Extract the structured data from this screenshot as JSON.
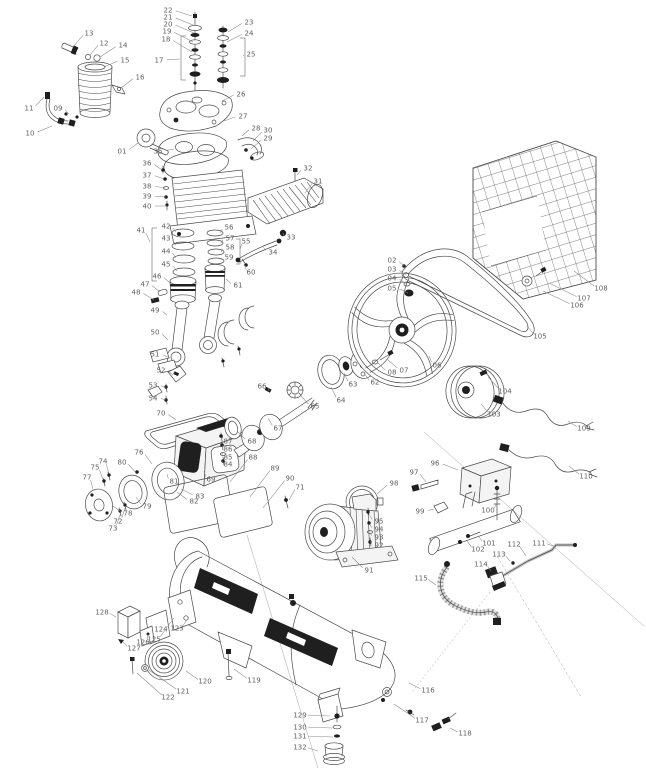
{
  "diagram": {
    "type": "exploded-parts-diagram",
    "canvas": {
      "width": 646,
      "height": 768
    },
    "colors": {
      "background": "#ffffff",
      "line": "#4a4a4a",
      "label": "#5f5f5f",
      "dark_fill": "#1f1f1f"
    },
    "callouts": [
      {
        "label": "22",
        "x": 168,
        "y": 10,
        "ex": 192,
        "ey": 16
      },
      {
        "label": "21",
        "x": 168,
        "y": 17,
        "ex": 193,
        "ey": 25
      },
      {
        "label": "20",
        "x": 168,
        "y": 24,
        "ex": 194,
        "ey": 33
      },
      {
        "label": "19",
        "x": 167,
        "y": 31,
        "ex": 193,
        "ey": 42
      },
      {
        "label": "18",
        "x": 166,
        "y": 39,
        "ex": 192,
        "ey": 52
      },
      {
        "label": "17",
        "x": 159,
        "y": 60,
        "ex": 180,
        "ey": 59
      },
      {
        "label": "23",
        "x": 249,
        "y": 22,
        "ex": 228,
        "ey": 32
      },
      {
        "label": "24",
        "x": 249,
        "y": 33,
        "ex": 227,
        "ey": 42
      },
      {
        "label": "25",
        "x": 251,
        "y": 54,
        "ex": 244,
        "ey": 56
      },
      {
        "label": "13",
        "x": 89,
        "y": 33,
        "ex": 73,
        "ey": 47
      },
      {
        "label": "12",
        "x": 104,
        "y": 43,
        "ex": 90,
        "ey": 55
      },
      {
        "label": "14",
        "x": 123,
        "y": 45,
        "ex": 100,
        "ey": 57
      },
      {
        "label": "15",
        "x": 125,
        "y": 60,
        "ex": 104,
        "ey": 67
      },
      {
        "label": "16",
        "x": 140,
        "y": 77,
        "ex": 121,
        "ey": 88
      },
      {
        "label": "11",
        "x": 29,
        "y": 108,
        "ex": 44,
        "ey": 97
      },
      {
        "label": "09",
        "x": 58,
        "y": 108,
        "ex": 69,
        "ey": 114
      },
      {
        "label": "10",
        "x": 30,
        "y": 133,
        "ex": 52,
        "ey": 126
      },
      {
        "label": "01",
        "x": 122,
        "y": 151,
        "ex": 138,
        "ey": 143
      },
      {
        "label": "26",
        "x": 241,
        "y": 94,
        "ex": 222,
        "ey": 101
      },
      {
        "label": "27",
        "x": 243,
        "y": 116,
        "ex": 224,
        "ey": 121
      },
      {
        "label": "28",
        "x": 256,
        "y": 128,
        "ex": 242,
        "ey": 136
      },
      {
        "label": "30",
        "x": 268,
        "y": 130,
        "ex": 253,
        "ey": 141
      },
      {
        "label": "29",
        "x": 268,
        "y": 138,
        "ex": 251,
        "ey": 149
      },
      {
        "label": "32",
        "x": 308,
        "y": 168,
        "ex": 297,
        "ey": 175
      },
      {
        "label": "31",
        "x": 318,
        "y": 181,
        "ex": 305,
        "ey": 193
      },
      {
        "label": "33",
        "x": 291,
        "y": 237,
        "ex": 283,
        "ey": 233
      },
      {
        "label": "34",
        "x": 273,
        "y": 252,
        "ex": 263,
        "ey": 247
      },
      {
        "label": "35",
        "x": 158,
        "y": 151,
        "ex": 174,
        "ey": 149
      },
      {
        "label": "36",
        "x": 147,
        "y": 163,
        "ex": 162,
        "ey": 170
      },
      {
        "label": "37",
        "x": 147,
        "y": 175,
        "ex": 164,
        "ey": 179
      },
      {
        "label": "38",
        "x": 147,
        "y": 186,
        "ex": 165,
        "ey": 188
      },
      {
        "label": "39",
        "x": 147,
        "y": 196,
        "ex": 166,
        "ey": 197
      },
      {
        "label": "40",
        "x": 147,
        "y": 206,
        "ex": 167,
        "ey": 206
      },
      {
        "label": "41",
        "x": 141,
        "y": 230,
        "ex": 150,
        "ey": 242
      },
      {
        "label": "42",
        "x": 166,
        "y": 226,
        "ex": 176,
        "ey": 232
      },
      {
        "label": "43",
        "x": 166,
        "y": 238,
        "ex": 176,
        "ey": 245
      },
      {
        "label": "44",
        "x": 166,
        "y": 251,
        "ex": 176,
        "ey": 258
      },
      {
        "label": "45",
        "x": 166,
        "y": 264,
        "ex": 177,
        "ey": 271
      },
      {
        "label": "55",
        "x": 246,
        "y": 241,
        "ex": 240,
        "ey": 250
      },
      {
        "label": "56",
        "x": 229,
        "y": 227,
        "ex": 220,
        "ey": 233
      },
      {
        "label": "57",
        "x": 230,
        "y": 238,
        "ex": 221,
        "ey": 243
      },
      {
        "label": "58",
        "x": 230,
        "y": 247,
        "ex": 221,
        "ey": 252
      },
      {
        "label": "59",
        "x": 229,
        "y": 257,
        "ex": 221,
        "ey": 260
      },
      {
        "label": "60",
        "x": 251,
        "y": 272,
        "ex": 245,
        "ey": 265
      },
      {
        "label": "61",
        "x": 238,
        "y": 285,
        "ex": 226,
        "ey": 279
      },
      {
        "label": "46",
        "x": 157,
        "y": 276,
        "ex": 170,
        "ey": 283
      },
      {
        "label": "47",
        "x": 145,
        "y": 284,
        "ex": 160,
        "ey": 292
      },
      {
        "label": "48",
        "x": 136,
        "y": 292,
        "ex": 154,
        "ey": 300
      },
      {
        "label": "49",
        "x": 155,
        "y": 310,
        "ex": 167,
        "ey": 315
      },
      {
        "label": "50",
        "x": 155,
        "y": 332,
        "ex": 168,
        "ey": 340
      },
      {
        "label": "51",
        "x": 155,
        "y": 354,
        "ex": 170,
        "ey": 358
      },
      {
        "label": "52",
        "x": 161,
        "y": 370,
        "ex": 173,
        "ey": 375
      },
      {
        "label": "53",
        "x": 153,
        "y": 385,
        "ex": 166,
        "ey": 388
      },
      {
        "label": "54",
        "x": 153,
        "y": 398,
        "ex": 166,
        "ey": 400
      },
      {
        "label": "70",
        "x": 161,
        "y": 413,
        "ex": 176,
        "ey": 420
      },
      {
        "label": "71",
        "x": 300,
        "y": 487,
        "ex": 289,
        "ey": 500
      },
      {
        "label": "66",
        "x": 262,
        "y": 386,
        "ex": 269,
        "ey": 391
      },
      {
        "label": "65",
        "x": 315,
        "y": 406,
        "ex": 301,
        "ey": 396
      },
      {
        "label": "67",
        "x": 278,
        "y": 428,
        "ex": 268,
        "ey": 418
      },
      {
        "label": "68",
        "x": 252,
        "y": 441,
        "ex": 238,
        "ey": 432
      },
      {
        "label": "69",
        "x": 211,
        "y": 479,
        "ex": 204,
        "ey": 471
      },
      {
        "label": "72",
        "x": 118,
        "y": 521,
        "ex": 125,
        "ey": 508
      },
      {
        "label": "73",
        "x": 113,
        "y": 528,
        "ex": 121,
        "ey": 512
      },
      {
        "label": "74",
        "x": 103,
        "y": 461,
        "ex": 109,
        "ey": 474
      },
      {
        "label": "75",
        "x": 95,
        "y": 467,
        "ex": 103,
        "ey": 479
      },
      {
        "label": "76",
        "x": 139,
        "y": 452,
        "ex": 152,
        "ey": 464
      },
      {
        "label": "77",
        "x": 87,
        "y": 477,
        "ex": 93,
        "ey": 489
      },
      {
        "label": "78",
        "x": 128,
        "y": 513,
        "ex": 113,
        "ey": 506
      },
      {
        "label": "79",
        "x": 147,
        "y": 506,
        "ex": 136,
        "ey": 497
      },
      {
        "label": "80",
        "x": 122,
        "y": 462,
        "ex": 136,
        "ey": 473
      },
      {
        "label": "81",
        "x": 174,
        "y": 481,
        "ex": 167,
        "ey": 474
      },
      {
        "label": "82",
        "x": 194,
        "y": 501,
        "ex": 177,
        "ey": 492
      },
      {
        "label": "83",
        "x": 200,
        "y": 496,
        "ex": 181,
        "ey": 489
      },
      {
        "label": "84",
        "x": 228,
        "y": 464,
        "ex": 223,
        "ey": 461
      },
      {
        "label": "85",
        "x": 228,
        "y": 457,
        "ex": 223,
        "ey": 453
      },
      {
        "label": "86",
        "x": 228,
        "y": 449,
        "ex": 223,
        "ey": 445
      },
      {
        "label": "87",
        "x": 228,
        "y": 441,
        "ex": 223,
        "ey": 437
      },
      {
        "label": "88",
        "x": 253,
        "y": 457,
        "ex": 230,
        "ey": 482
      },
      {
        "label": "89",
        "x": 275,
        "y": 468,
        "ex": 250,
        "ey": 497
      },
      {
        "label": "90",
        "x": 290,
        "y": 478,
        "ex": 263,
        "ey": 508
      },
      {
        "label": "02",
        "x": 392,
        "y": 260,
        "ex": 404,
        "ey": 266
      },
      {
        "label": "03",
        "x": 392,
        "y": 269,
        "ex": 406,
        "ey": 275
      },
      {
        "label": "04",
        "x": 392,
        "y": 278,
        "ex": 407,
        "ey": 284
      },
      {
        "label": "05",
        "x": 392,
        "y": 288,
        "ex": 408,
        "ey": 293
      },
      {
        "label": "06",
        "x": 437,
        "y": 365,
        "ex": 429,
        "ey": 356
      },
      {
        "label": "07",
        "x": 404,
        "y": 370,
        "ex": 387,
        "ey": 359
      },
      {
        "label": "08",
        "x": 392,
        "y": 372,
        "ex": 377,
        "ey": 362
      },
      {
        "label": "62",
        "x": 375,
        "y": 382,
        "ex": 364,
        "ey": 373
      },
      {
        "label": "63",
        "x": 353,
        "y": 384,
        "ex": 344,
        "ey": 373
      },
      {
        "label": "64",
        "x": 341,
        "y": 400,
        "ex": 331,
        "ey": 387
      },
      {
        "label": "91",
        "x": 369,
        "y": 570,
        "ex": 352,
        "ey": 557
      },
      {
        "label": "92",
        "x": 379,
        "y": 545,
        "ex": 370,
        "ey": 541
      },
      {
        "label": "93",
        "x": 379,
        "y": 537,
        "ex": 370,
        "ey": 533
      },
      {
        "label": "94",
        "x": 379,
        "y": 529,
        "ex": 370,
        "ey": 525
      },
      {
        "label": "95",
        "x": 379,
        "y": 521,
        "ex": 370,
        "ey": 516
      },
      {
        "label": "96",
        "x": 435,
        "y": 463,
        "ex": 458,
        "ey": 470
      },
      {
        "label": "97",
        "x": 414,
        "y": 472,
        "ex": 426,
        "ey": 482
      },
      {
        "label": "98",
        "x": 394,
        "y": 483,
        "ex": 377,
        "ey": 494
      },
      {
        "label": "99",
        "x": 420,
        "y": 511,
        "ex": 434,
        "ey": 509
      },
      {
        "label": "100",
        "x": 488,
        "y": 510,
        "ex": 497,
        "ey": 503
      },
      {
        "label": "101",
        "x": 489,
        "y": 543,
        "ex": 478,
        "ey": 536
      },
      {
        "label": "102",
        "x": 478,
        "y": 549,
        "ex": 467,
        "ey": 541
      },
      {
        "label": "103",
        "x": 494,
        "y": 414,
        "ex": 481,
        "ey": 404
      },
      {
        "label": "104",
        "x": 505,
        "y": 391,
        "ex": 488,
        "ey": 377
      },
      {
        "label": "105",
        "x": 540,
        "y": 336,
        "ex": 527,
        "ey": 326
      },
      {
        "label": "106",
        "x": 577,
        "y": 305,
        "ex": 543,
        "ey": 291
      },
      {
        "label": "107",
        "x": 584,
        "y": 298,
        "ex": 549,
        "ey": 283
      },
      {
        "label": "108",
        "x": 601,
        "y": 288,
        "ex": 574,
        "ey": 271
      },
      {
        "label": "109",
        "x": 584,
        "y": 428,
        "ex": 568,
        "ey": 421
      },
      {
        "label": "110",
        "x": 586,
        "y": 476,
        "ex": 569,
        "ey": 466
      },
      {
        "label": "111",
        "x": 539,
        "y": 543,
        "ex": 556,
        "ey": 547
      },
      {
        "label": "112",
        "x": 514,
        "y": 544,
        "ex": 526,
        "ey": 556
      },
      {
        "label": "113",
        "x": 499,
        "y": 554,
        "ex": 510,
        "ey": 561
      },
      {
        "label": "114",
        "x": 481,
        "y": 564,
        "ex": 491,
        "ey": 571
      },
      {
        "label": "115",
        "x": 421,
        "y": 578,
        "ex": 436,
        "ey": 585
      },
      {
        "label": "116",
        "x": 428,
        "y": 690,
        "ex": 409,
        "ey": 683
      },
      {
        "label": "117",
        "x": 422,
        "y": 720,
        "ex": 394,
        "ey": 704
      },
      {
        "label": "118",
        "x": 465,
        "y": 733,
        "ex": 450,
        "ey": 728
      },
      {
        "label": "119",
        "x": 254,
        "y": 680,
        "ex": 234,
        "ey": 669
      },
      {
        "label": "120",
        "x": 205,
        "y": 681,
        "ex": 186,
        "ey": 671
      },
      {
        "label": "121",
        "x": 183,
        "y": 691,
        "ex": 149,
        "ey": 670
      },
      {
        "label": "122",
        "x": 168,
        "y": 697,
        "ex": 137,
        "ey": 673
      },
      {
        "label": "123",
        "x": 177,
        "y": 628,
        "ex": 189,
        "ey": 617
      },
      {
        "label": "124",
        "x": 161,
        "y": 629,
        "ex": 174,
        "ey": 618
      },
      {
        "label": "125",
        "x": 154,
        "y": 639,
        "ex": 166,
        "ey": 629
      },
      {
        "label": "126",
        "x": 143,
        "y": 642,
        "ex": 148,
        "ey": 634
      },
      {
        "label": "127",
        "x": 134,
        "y": 648,
        "ex": 123,
        "ey": 642
      },
      {
        "label": "128",
        "x": 102,
        "y": 612,
        "ex": 116,
        "ey": 617
      },
      {
        "label": "129",
        "x": 300,
        "y": 715,
        "ex": 330,
        "ey": 716
      },
      {
        "label": "130",
        "x": 300,
        "y": 727,
        "ex": 332,
        "ey": 728
      },
      {
        "label": "131",
        "x": 300,
        "y": 736,
        "ex": 333,
        "ey": 737
      },
      {
        "label": "132",
        "x": 300,
        "y": 747,
        "ex": 318,
        "ey": 751
      }
    ]
  }
}
